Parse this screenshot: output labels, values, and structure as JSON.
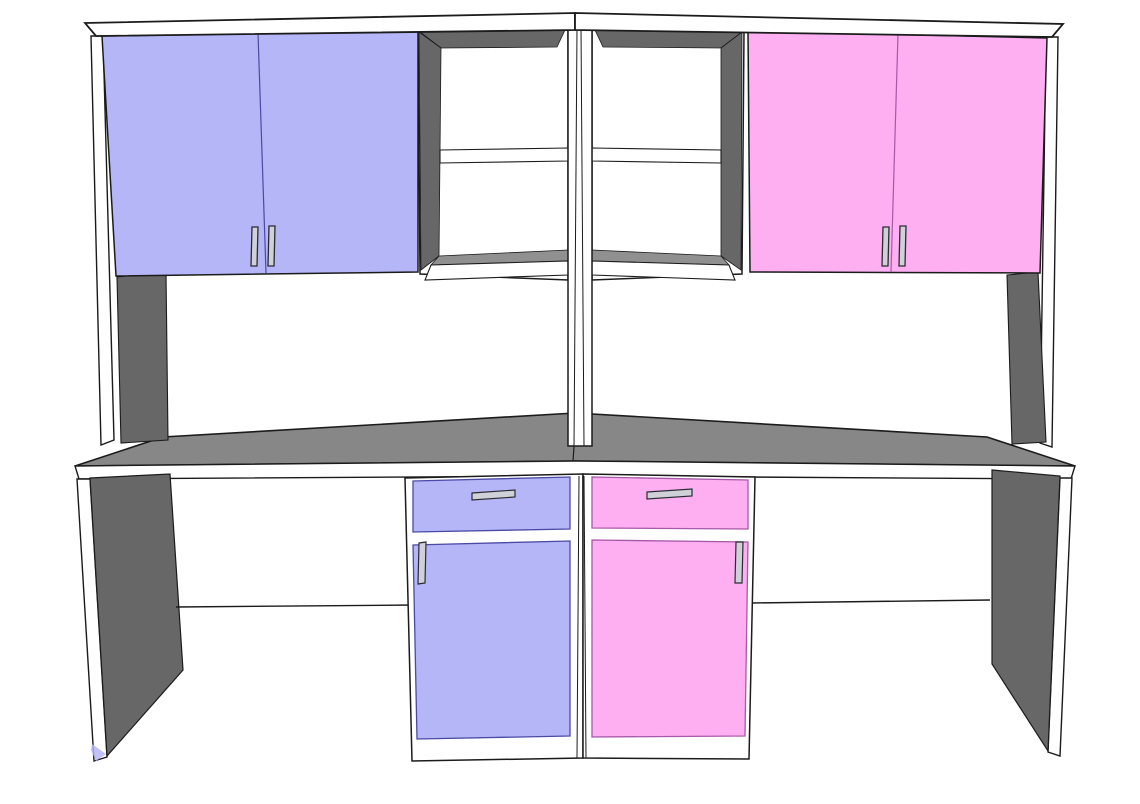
{
  "scene": {
    "description": "3D line-render drawing of a twin study desk with overhead hutch",
    "render_style": "cad-line-drawing",
    "background": "white"
  },
  "colors": {
    "background": "#ffffff",
    "outline": "#1b1b1b",
    "lavender": "#b5b6f7",
    "lavender_edge": "#4a4aa6",
    "pink": "#fdaff2",
    "pink_edge": "#a758a7",
    "surface_gray": "#878787",
    "panel_gray": "#676767",
    "shelf_gray": "#909090",
    "white": "#ffffff",
    "handle_fill": "#cfd0d8",
    "handle_edge": "#2a2a33"
  },
  "components": {
    "hutch": {
      "top_boards": 2,
      "upper_cabinet_left": {
        "color_key": "lavender",
        "doors": 2,
        "handles": 2
      },
      "upper_cabinet_right": {
        "color_key": "pink",
        "doors": 2,
        "handles": 2
      },
      "open_shelf_units": 2,
      "cubbies_per_unit": 2,
      "center_divider_panels": 2
    },
    "desk": {
      "desktop_color_key": "surface_gray",
      "side_panels": 2,
      "modesty_panels": 2,
      "pedestal_left": {
        "color_key": "lavender",
        "drawers": 1,
        "doors": 1,
        "drawer_handles": 1,
        "door_handles": 1
      },
      "pedestal_right": {
        "color_key": "pink",
        "drawers": 1,
        "doors": 1,
        "drawer_handles": 1,
        "door_handles": 1
      }
    }
  }
}
